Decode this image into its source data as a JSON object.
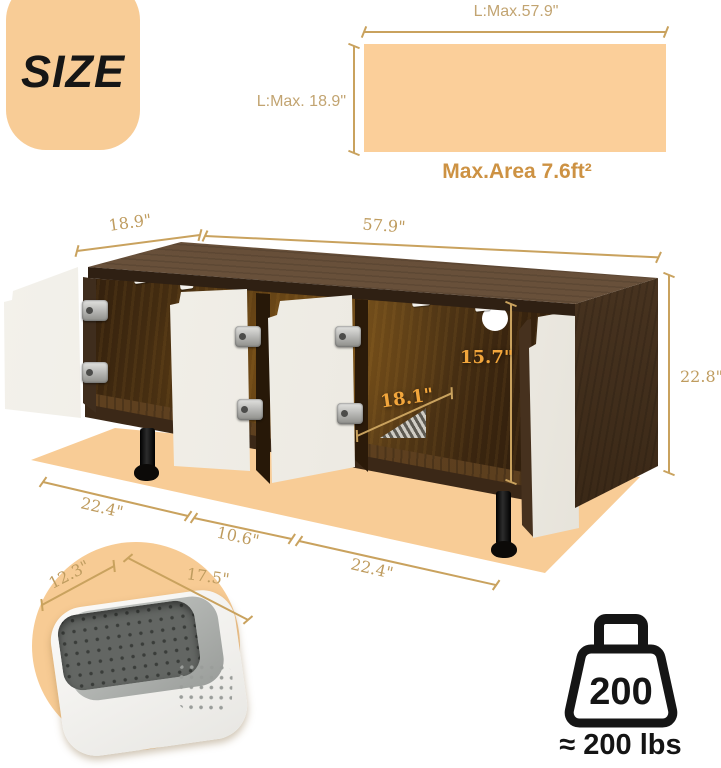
{
  "size_badge": {
    "label": "SIZE"
  },
  "top_area_diagram": {
    "length_label": "L:Max.57.9\"",
    "depth_label": "L:Max. 18.9\"",
    "area_label": "Max.Area 7.6ft²"
  },
  "cabinet_dims": {
    "top_depth": "18.9\"",
    "top_length": "57.9\"",
    "height": "22.8\"",
    "inner_height": "15.7\"",
    "inner_depth": "18.1\"",
    "base_left": "22.4\"",
    "base_center": "10.6\"",
    "base_right": "22.4\""
  },
  "litter_pan_dims": {
    "width": "12.3\"",
    "length": "17.5\""
  },
  "weight_capacity": {
    "icon_value": "200",
    "label": "≈ 200 lbs"
  },
  "colors": {
    "peach": "#f8cc96",
    "dim_line_gold": "#c9a25e",
    "dim_text_gold": "#bf9c5f",
    "inner_dim_amber": "#f2a63c",
    "area_text_orange": "#cd9243"
  }
}
